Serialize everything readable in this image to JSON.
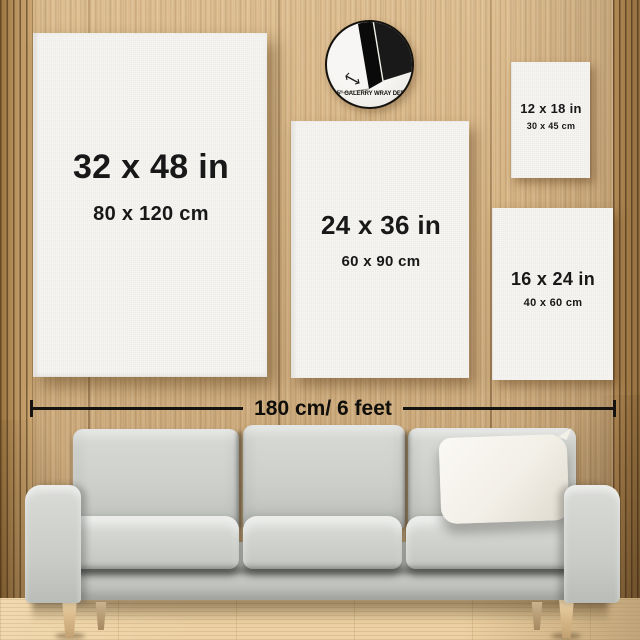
{
  "scene": {
    "description": "Canvas print size comparison on wood-slat wall above a sofa"
  },
  "badge": {
    "label": "1.5\" GALERRY WRAY DEPT"
  },
  "canvases": [
    {
      "id": "32x48",
      "size_in": "32 x 48 in",
      "size_cm": "80 x 120 cm"
    },
    {
      "id": "24x36",
      "size_in": "24 x 36 in",
      "size_cm": "60 x 90 cm"
    },
    {
      "id": "12x18",
      "size_in": "12 x 18 in",
      "size_cm": "30 x 45 cm"
    },
    {
      "id": "16x24",
      "size_in": "16 x 24 in",
      "size_cm": "40 x 60 cm"
    }
  ],
  "ruler": {
    "label": "180 cm/ 6 feet"
  },
  "colors": {
    "wall_wood": "#d7b484",
    "floor_wood": "#ecd2a4",
    "canvas_face": "#f6f5f2",
    "label_text": "#181818",
    "ruler_line": "#151310",
    "sofa_fabric": "#ccd0cb",
    "throw_pillow": "#f3f0e8",
    "leg_wood": "#d6b687"
  }
}
